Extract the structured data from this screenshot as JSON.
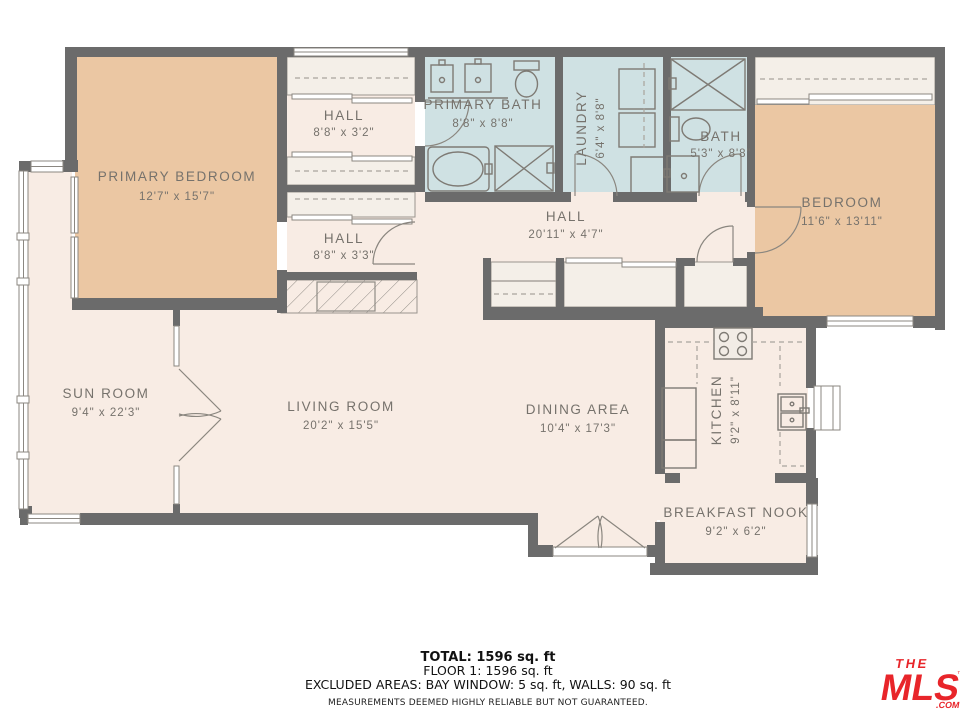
{
  "rooms": {
    "primary_bedroom": {
      "label": "PRIMARY BEDROOM",
      "dims": "12'7\" x 15'7\""
    },
    "hall_top": {
      "label": "HALL",
      "dims": "8'8\" x 3'2\""
    },
    "hall_mid": {
      "label": "HALL",
      "dims": "8'8\" x 3'3\""
    },
    "primary_bath": {
      "label": "PRIMARY BATH",
      "dims": "8'8\" x 8'8\""
    },
    "laundry": {
      "label": "LAUNDRY",
      "dims": "6'4\" x 8'8\""
    },
    "bath": {
      "label": "BATH",
      "dims": "5'3\" x 8'8\""
    },
    "bedroom": {
      "label": "BEDROOM",
      "dims": "11'6\" x 13'11\""
    },
    "hall_center": {
      "label": "HALL",
      "dims": "20'11\" x 4'7\""
    },
    "sun_room": {
      "label": "SUN ROOM",
      "dims": "9'4\" x 22'3\""
    },
    "living_room": {
      "label": "LIVING ROOM",
      "dims": "20'2\" x 15'5\""
    },
    "dining_area": {
      "label": "DINING AREA",
      "dims": "10'4\" x 17'3\""
    },
    "kitchen": {
      "label": "KITCHEN",
      "dims": "9'2\" x 8'11\""
    },
    "breakfast_nook": {
      "label": "BREAKFAST NOOK",
      "dims": "9'2\" x 6'2\""
    }
  },
  "footer": {
    "total": "TOTAL: 1596 sq. ft",
    "floor": "FLOOR 1: 1596 sq. ft",
    "excluded": "EXCLUDED AREAS: BAY WINDOW: 5 sq. ft, WALLS: 90 sq. ft",
    "disclaimer": "MEASUREMENTS DEEMED HIGHLY RELIABLE BUT NOT GUARANTEED."
  },
  "logo": {
    "the": "THE",
    "mls": "MLS",
    "tm": "™",
    "com": ".COM"
  },
  "colors": {
    "wall": "#6b6b6b",
    "room_cream": "#f8ece4",
    "closet_cream": "#f4efe8",
    "bedroom_tan": "#ebc7a3",
    "bath_blue": "#cfe1e3",
    "label_gray": "#76726c",
    "logo_red": "#e8252a"
  }
}
